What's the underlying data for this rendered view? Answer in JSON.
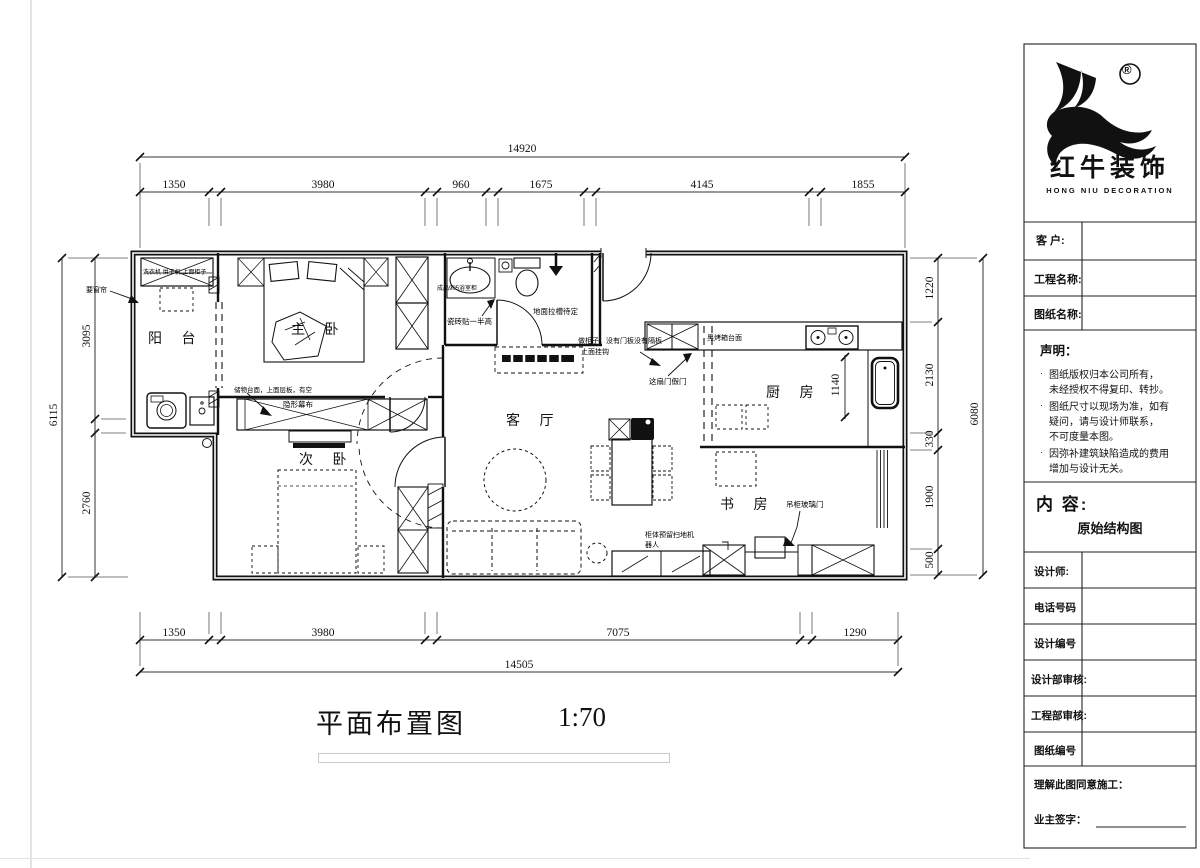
{
  "sheet": {
    "plan_title": "平面布置图",
    "plan_scale": "1:70"
  },
  "rooms": {
    "balcony": "阳 台",
    "master": "主 卧",
    "second": "次 卧",
    "living": "客 厅",
    "kitchen": "厨 房",
    "study": "书 房"
  },
  "dimensions": {
    "top": {
      "overall": "14920",
      "segments": [
        "1350",
        "3980",
        "960",
        "1675",
        "4145",
        "1855"
      ]
    },
    "bottom": {
      "overall": "14505",
      "segments": [
        "1350",
        "3980",
        "7075",
        "1290"
      ]
    },
    "left": {
      "overall": "6115",
      "segments": [
        "3095",
        "2760"
      ]
    },
    "right": {
      "overall": "6080",
      "segments": [
        "1220",
        "2130",
        "330",
        "1900",
        "500"
      ]
    },
    "kitchen_counter": "1140"
  },
  "annotations": {
    "curtain": "要窗帘",
    "balcony_cabinet": "洗衣机 烘干机 上面柜子",
    "vanity": "成品905浴室柜",
    "tile_half": "瓷砖贴一半高",
    "floor_groove": "地面拉槽待定",
    "open_cabinet": "做柜子，没有门板没有隔板",
    "hooks": "上面挂钩",
    "fake_door": "这扇门假门",
    "oven_counter": "黑烤箱台面",
    "storage_counter": "储物台面，上面层板，有空",
    "hidden_screen": "隐形幕布",
    "robot_line1": "柜体预留扫地机",
    "robot_line2": "器人",
    "glass_door": "吊柜玻璃门"
  },
  "title_block": {
    "brand": {
      "cn": "红牛装饰",
      "en": "HONG NIU DECORATION",
      "mark": "®"
    },
    "customer_label": "客  户:",
    "project_label": "工程名称:",
    "drawing_label": "图纸名称:",
    "statement": {
      "heading": "声明：",
      "item1_line1": "图纸版权归本公司所有，",
      "item1_line2": "未经授权不得复印、转抄。",
      "item2_line1": "图纸尺寸以现场为准，如有",
      "item2_line2": "疑问，请与设计师联系，",
      "item2_line3": "不可度量本图。",
      "item3_line1": "因弥补建筑缺陷造成的费用",
      "item3_line2": "增加与设计无关。"
    },
    "content": {
      "heading": "内  容:",
      "value": "原始结构图"
    },
    "rows": {
      "designer": "设计师:",
      "phone": "电话号码",
      "design_no": "设计编号",
      "design_review": "设计部审核:",
      "engineering_review": "工程部审核:",
      "sheet_no": "图纸编号"
    },
    "agreement": "理解此图同意施工：",
    "signature": "业主签字："
  }
}
